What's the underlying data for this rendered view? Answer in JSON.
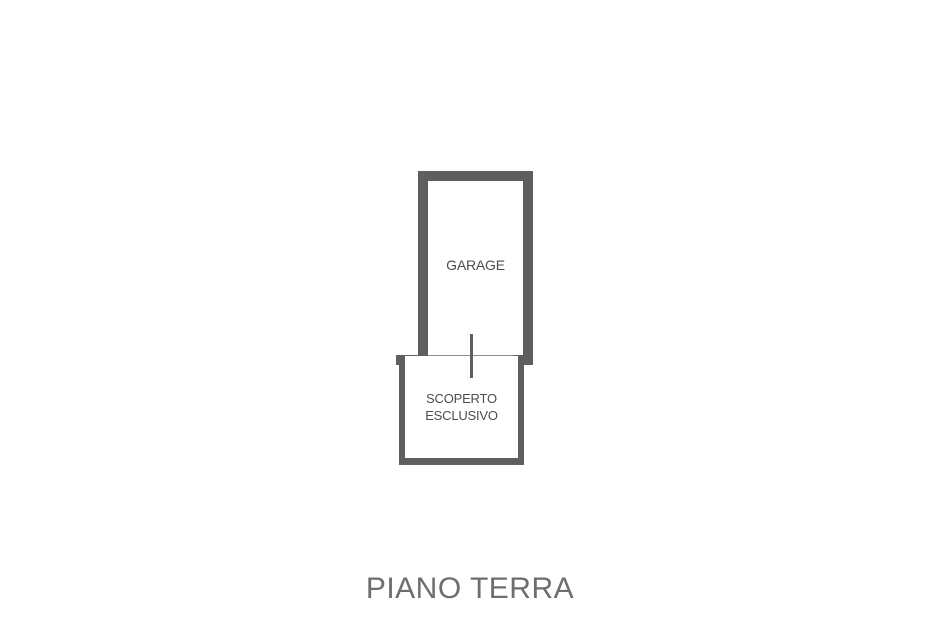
{
  "plan": {
    "rooms": {
      "garage": {
        "label": "GARAGE"
      },
      "scoperto": {
        "label_line1": "SCOPERTO",
        "label_line2": "ESCLUSIVO"
      }
    },
    "title": "PIANO TERRA"
  },
  "colors": {
    "background": "#ffffff",
    "wall": "#5f5f5f",
    "threshold": "#8e8e8e",
    "room_label": "#4d4d4d",
    "title": "#6e6e6e"
  }
}
